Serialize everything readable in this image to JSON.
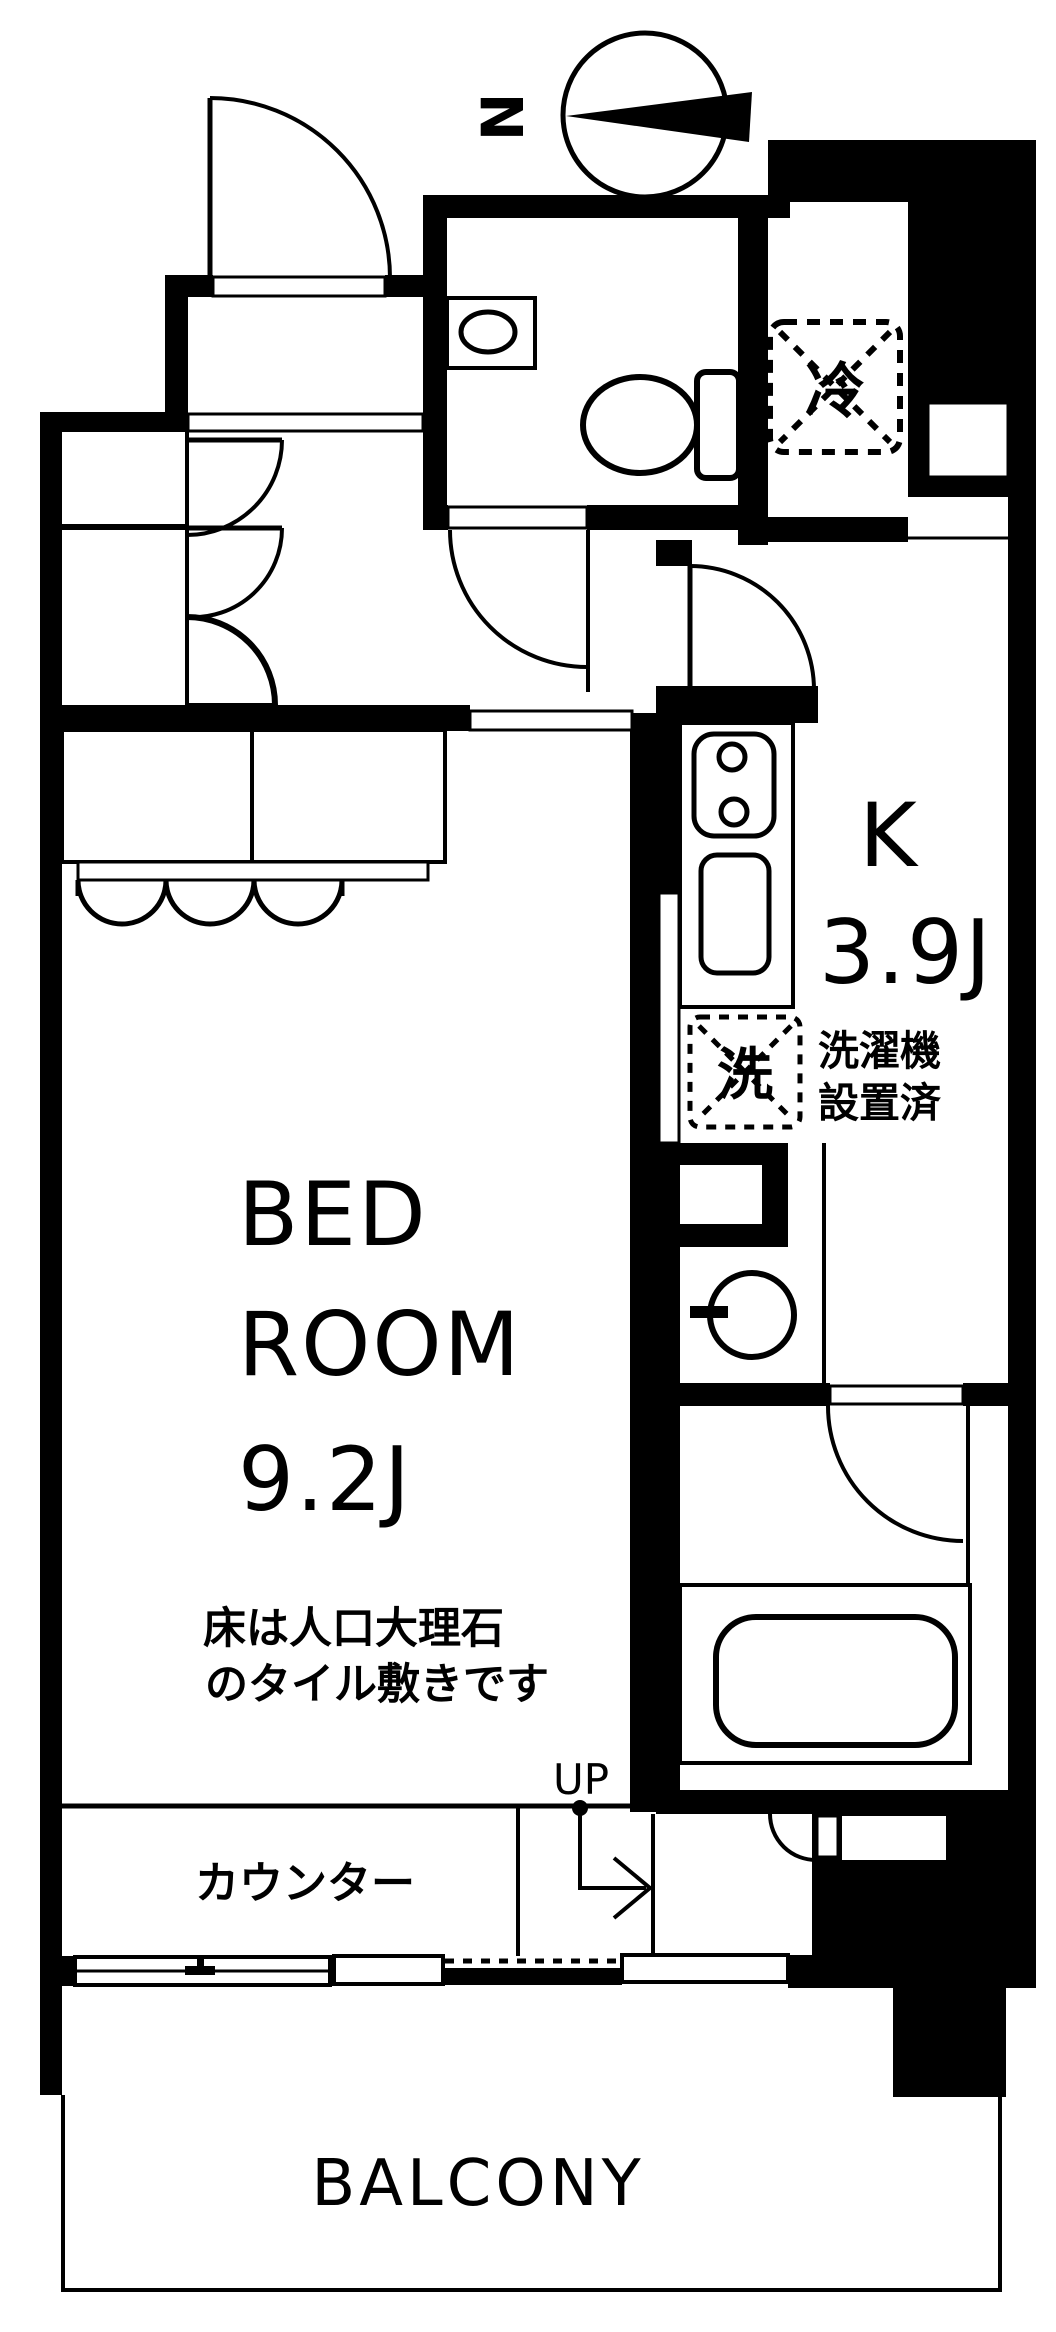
{
  "page": {
    "background": "#ffffff",
    "ink": "#000000"
  },
  "compass": {
    "north_label": "N"
  },
  "labels": {
    "refrigerator_symbol": "冷",
    "kitchen_name": "K",
    "kitchen_size": "3.9J",
    "washer_symbol": "洗",
    "washer_note_line1": "洗濯機",
    "washer_note_line2": "設置済",
    "bedroom_line1": "BED",
    "bedroom_line2": "ROOM",
    "bedroom_size": "9.2J",
    "floor_note_line1": "床は人口大理石",
    "floor_note_line2": "のタイル敷きです",
    "counter": "カウンター",
    "stairs_up": "UP",
    "balcony": "BALCONY"
  }
}
